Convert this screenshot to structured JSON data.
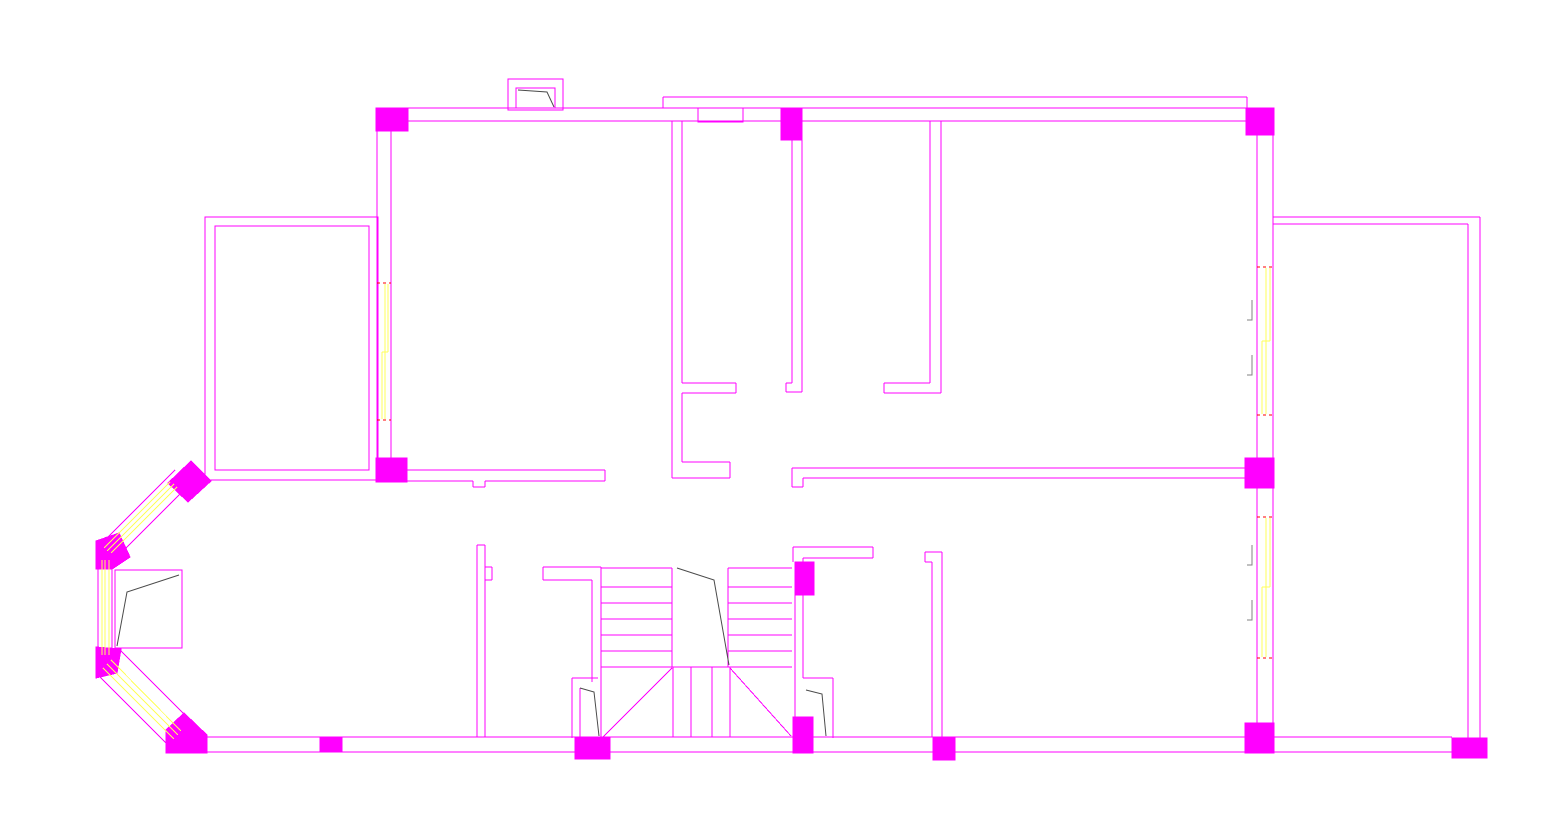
{
  "drawing": {
    "type": "cad-architectural-floor-plan",
    "description": "Residential floor plan line drawing, magenta wall lines, filled magenta columns, yellow window glazing, stair with break line, door swing arcs",
    "canvas": {
      "width": 1551,
      "height": 824,
      "background": "#ffffff"
    },
    "colors": {
      "wall": "#ff00ff",
      "column_fill": "#ff00ff",
      "window_glazing": "#ffff5a",
      "window_end_mark": "#ff0000",
      "door_swing": "#4a4a4a",
      "window_label_mark": "#808080"
    },
    "floorplan": {
      "wall_segments": [
        [
          376,
          108,
          1274,
          108
        ],
        [
          392,
          121,
          1257,
          121
        ],
        [
          663,
          97,
          1247,
          97
        ],
        [
          663,
          97,
          663,
          108
        ],
        [
          1247,
          97,
          1247,
          108
        ],
        [
          377,
          131,
          377,
          458
        ],
        [
          391,
          121,
          391,
          458
        ],
        [
          407,
          470,
          605,
          470
        ],
        [
          407,
          481,
          473,
          481
        ],
        [
          485,
          481,
          605,
          481
        ],
        [
          605,
          470,
          605,
          481
        ],
        [
          473,
          481,
          473,
          487
        ],
        [
          473,
          487,
          485,
          487
        ],
        [
          485,
          487,
          485,
          481
        ],
        [
          672,
          121,
          672,
          478
        ],
        [
          682,
          121,
          682,
          383
        ],
        [
          682,
          393,
          682,
          462
        ],
        [
          682,
          383,
          736,
          383
        ],
        [
          682,
          393,
          736,
          393
        ],
        [
          736,
          383,
          736,
          393
        ],
        [
          682,
          462,
          730,
          462
        ],
        [
          672,
          478,
          730,
          478
        ],
        [
          730,
          462,
          730,
          478
        ],
        [
          792,
          140,
          792,
          383
        ],
        [
          802,
          140,
          802,
          392
        ],
        [
          786,
          383,
          792,
          383
        ],
        [
          786,
          383,
          786,
          392
        ],
        [
          786,
          392,
          802,
          392
        ],
        [
          930,
          121,
          930,
          383
        ],
        [
          941,
          121,
          941,
          393
        ],
        [
          884,
          383,
          930,
          383
        ],
        [
          884,
          393,
          941,
          393
        ],
        [
          884,
          383,
          884,
          393
        ],
        [
          792,
          468,
          1245,
          468
        ],
        [
          803,
          478,
          1245,
          478
        ],
        [
          792,
          468,
          792,
          487
        ],
        [
          792,
          487,
          803,
          487
        ],
        [
          803,
          487,
          803,
          478
        ],
        [
          1257,
          135,
          1257,
          723
        ],
        [
          1273,
          135,
          1273,
          723
        ],
        [
          1273,
          217,
          1480,
          217
        ],
        [
          1273,
          224,
          1468,
          224
        ],
        [
          1480,
          217,
          1480,
          738
        ],
        [
          1468,
          224,
          1468,
          738
        ],
        [
          200,
          737,
          1452,
          737
        ],
        [
          205,
          752,
          1452,
          752
        ],
        [
          477,
          545,
          477,
          737
        ],
        [
          485,
          545,
          485,
          737
        ],
        [
          477,
          545,
          485,
          545
        ],
        [
          485,
          567,
          492,
          567
        ],
        [
          492,
          567,
          492,
          580
        ],
        [
          485,
          580,
          492,
          580
        ],
        [
          543,
          567,
          601,
          567
        ],
        [
          543,
          580,
          592,
          580
        ],
        [
          543,
          567,
          543,
          580
        ],
        [
          592,
          580,
          592,
          682
        ],
        [
          601,
          567,
          601,
          682
        ],
        [
          601,
          682,
          601,
          738
        ],
        [
          572,
          678,
          572,
          738
        ],
        [
          572,
          678,
          598,
          678
        ],
        [
          580,
          688,
          580,
          738
        ],
        [
          601,
          568,
          672,
          568
        ],
        [
          601,
          587,
          672,
          587
        ],
        [
          601,
          603,
          672,
          603
        ],
        [
          601,
          619,
          672,
          619
        ],
        [
          601,
          635,
          672,
          635
        ],
        [
          601,
          651,
          672,
          651
        ],
        [
          728,
          568,
          792,
          568
        ],
        [
          728,
          587,
          792,
          587
        ],
        [
          728,
          603,
          792,
          603
        ],
        [
          728,
          619,
          792,
          619
        ],
        [
          728,
          635,
          792,
          635
        ],
        [
          728,
          651,
          792,
          651
        ],
        [
          672,
          568,
          672,
          667
        ],
        [
          728,
          568,
          728,
          667
        ],
        [
          601,
          667,
          792,
          667
        ],
        [
          673,
          667,
          673,
          737
        ],
        [
          691,
          667,
          691,
          737
        ],
        [
          712,
          667,
          712,
          737
        ],
        [
          730,
          667,
          730,
          737
        ],
        [
          603,
          737,
          672,
          668
        ],
        [
          730,
          668,
          791,
          736
        ],
        [
          795,
          595,
          795,
          718
        ],
        [
          803,
          595,
          803,
          678
        ],
        [
          793,
          547,
          873,
          547
        ],
        [
          803,
          558,
          873,
          558
        ],
        [
          873,
          547,
          873,
          558
        ],
        [
          793,
          547,
          793,
          562
        ],
        [
          803,
          558,
          803,
          562
        ],
        [
          803,
          678,
          833,
          678
        ],
        [
          833,
          678,
          833,
          738
        ],
        [
          932,
          562,
          932,
          737
        ],
        [
          942,
          552,
          942,
          737
        ],
        [
          925,
          552,
          942,
          552
        ],
        [
          925,
          552,
          925,
          562
        ],
        [
          925,
          562,
          932,
          562
        ],
        [
          175,
          470,
          100,
          545
        ],
        [
          190,
          484,
          114,
          560
        ],
        [
          98,
          541,
          98,
          677
        ],
        [
          112,
          558,
          112,
          662
        ],
        [
          99,
          676,
          168,
          745
        ],
        [
          119,
          649,
          186,
          716
        ]
      ],
      "wall_rects": [
        [
          508,
          79,
          55,
          31
        ],
        [
          516,
          88,
          39,
          20
        ],
        [
          698,
          108,
          45,
          14
        ],
        [
          205,
          217,
          173,
          263
        ],
        [
          215,
          226,
          154,
          244
        ],
        [
          115,
          570,
          67,
          78
        ]
      ],
      "columns": [
        [
          376,
          108,
          32,
          23
        ],
        [
          781,
          108,
          21,
          32
        ],
        [
          1246,
          108,
          28,
          27
        ],
        [
          376,
          458,
          31,
          24
        ],
        [
          1245,
          458,
          29,
          30
        ],
        [
          795,
          562,
          19,
          33
        ],
        [
          575,
          737,
          35,
          22
        ],
        [
          793,
          717,
          20,
          36
        ],
        [
          320,
          738,
          22,
          14
        ],
        [
          933,
          737,
          22,
          23
        ],
        [
          1245,
          723,
          29,
          30
        ],
        [
          1452,
          738,
          35,
          20
        ]
      ],
      "bay_columns": [
        [
          [
            168,
            483
          ],
          [
            191,
            461
          ],
          [
            211,
            481
          ],
          [
            188,
            502
          ]
        ],
        [
          [
            96,
            541
          ],
          [
            119,
            533
          ],
          [
            130,
            557
          ],
          [
            112,
            569
          ],
          [
            96,
            569
          ]
        ],
        [
          [
            96,
            647
          ],
          [
            121,
            649
          ],
          [
            117,
            673
          ],
          [
            96,
            678
          ]
        ],
        [
          [
            166,
            730
          ],
          [
            184,
            713
          ],
          [
            207,
            735
          ],
          [
            207,
            753
          ],
          [
            166,
            753
          ]
        ]
      ],
      "window_glazing": [
        [
          385,
          284,
          385,
          352
        ],
        [
          388,
          284,
          388,
          352
        ],
        [
          382,
          352,
          382,
          419
        ],
        [
          385,
          352,
          385,
          419
        ],
        [
          382,
          352,
          388,
          352
        ],
        [
          1266,
          268,
          1266,
          341
        ],
        [
          1270,
          268,
          1270,
          341
        ],
        [
          1262,
          341,
          1262,
          414
        ],
        [
          1266,
          341,
          1266,
          414
        ],
        [
          1262,
          341,
          1270,
          341
        ],
        [
          1266,
          518,
          1266,
          587
        ],
        [
          1270,
          518,
          1270,
          587
        ],
        [
          1262,
          587,
          1262,
          657
        ],
        [
          1266,
          587,
          1266,
          657
        ],
        [
          1262,
          587,
          1270,
          587
        ],
        [
          170,
          482,
          104,
          548
        ],
        [
          174,
          484,
          107,
          551
        ],
        [
          177,
          487,
          111,
          553
        ],
        [
          102,
          560,
          102,
          655
        ],
        [
          105,
          560,
          105,
          655
        ],
        [
          109,
          560,
          109,
          655
        ],
        [
          103,
          668,
          174,
          739
        ],
        [
          107,
          664,
          178,
          735
        ],
        [
          111,
          660,
          181,
          731
        ]
      ],
      "window_end_marks": [
        [
          377,
          283,
          391,
          283
        ],
        [
          377,
          420,
          391,
          420
        ],
        [
          1257,
          267,
          1273,
          267
        ],
        [
          1257,
          415,
          1273,
          415
        ],
        [
          1257,
          517,
          1273,
          517
        ],
        [
          1257,
          658,
          1273,
          658
        ]
      ],
      "door_swings": [
        [
          [
            518,
            90
          ],
          [
            547,
            92
          ],
          [
            554,
            107
          ]
        ],
        [
          [
            117,
            646
          ],
          [
            127,
            592
          ],
          [
            179,
            575
          ]
        ],
        [
          [
            677,
            568
          ],
          [
            714,
            580
          ],
          [
            729,
            665
          ]
        ],
        [
          [
            580,
            688
          ],
          [
            594,
            692
          ],
          [
            599,
            736
          ]
        ],
        [
          [
            806,
            690
          ],
          [
            822,
            694
          ],
          [
            826,
            736
          ]
        ]
      ],
      "window_label_marks": [
        [
          [
            1252,
            300
          ],
          [
            1252,
            320
          ],
          [
            1247,
            320
          ]
        ],
        [
          [
            1252,
            355
          ],
          [
            1252,
            375
          ],
          [
            1247,
            375
          ]
        ],
        [
          [
            1252,
            545
          ],
          [
            1252,
            565
          ],
          [
            1247,
            565
          ]
        ],
        [
          [
            1252,
            600
          ],
          [
            1252,
            620
          ],
          [
            1247,
            620
          ]
        ]
      ]
    }
  }
}
